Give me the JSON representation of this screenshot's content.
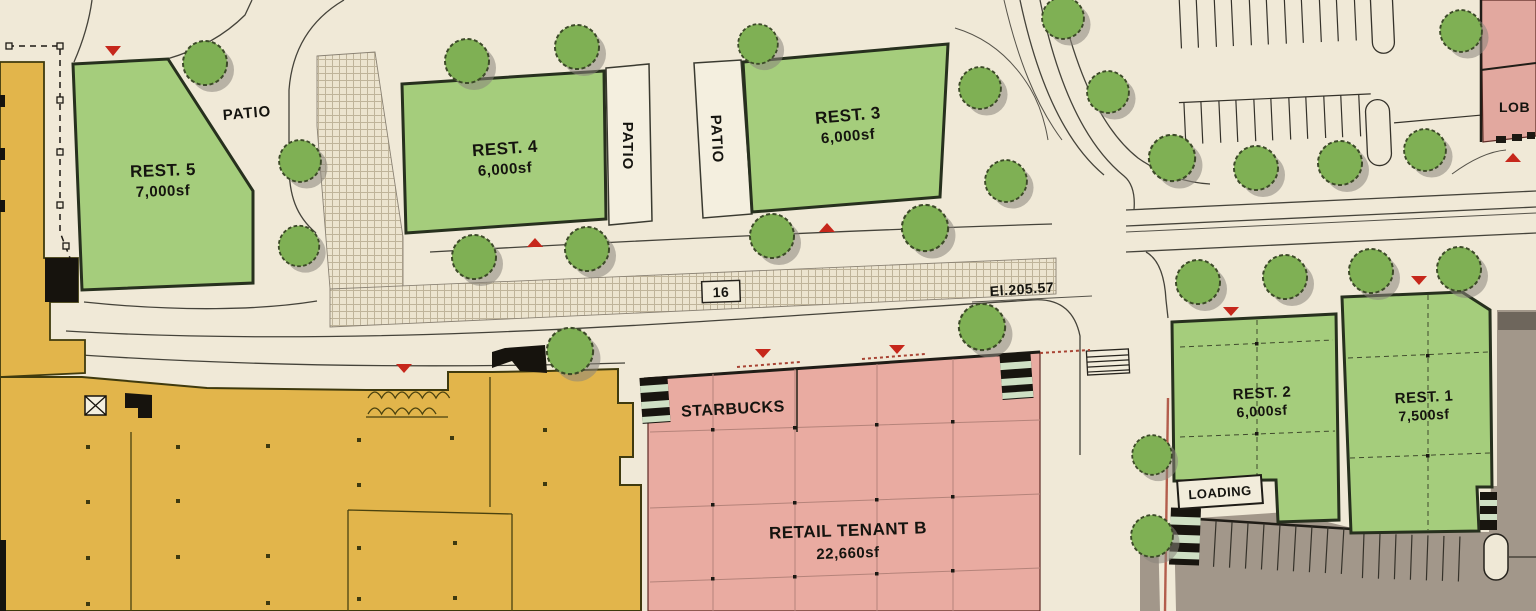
{
  "plan": {
    "buildings": {
      "rest5": {
        "name": "REST. 5",
        "area": "7,000sf"
      },
      "rest4": {
        "name": "REST. 4",
        "area": "6,000sf"
      },
      "rest3": {
        "name": "REST. 3",
        "area": "6,000sf"
      },
      "rest2": {
        "name": "REST. 2",
        "area": "6,000sf"
      },
      "rest1": {
        "name": "REST. 1",
        "area": "7,500sf"
      },
      "retail_tenant_b": {
        "name": "RETAIL TENANT B",
        "area": "22,660sf"
      },
      "starbucks": {
        "name": "STARBUCKS"
      },
      "lobby": {
        "name": "LOB"
      }
    },
    "labels": {
      "patio": "PATIO",
      "loading": "LOADING",
      "keynote": "16",
      "elevation": "El.205.57"
    },
    "colors": {
      "paper": "#f0e9d7",
      "restaurant_green": "#a5cd7c",
      "retail_pink": "#e9aba1",
      "anchor_yellow": "#e2b54b",
      "tree_green": "#7fb054",
      "service_gray": "#a2978a",
      "marker_red": "#c6271b"
    }
  }
}
